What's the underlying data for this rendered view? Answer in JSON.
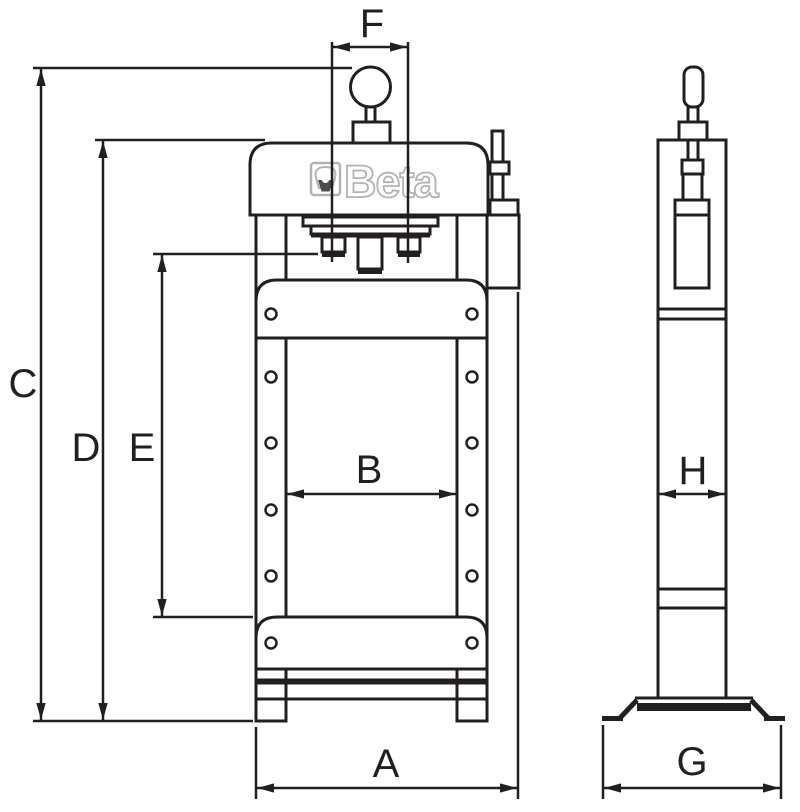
{
  "logo": {
    "text": "Beta"
  },
  "labels": {
    "A": "A",
    "B": "B",
    "C": "C",
    "D": "D",
    "E": "E",
    "F": "F",
    "G": "G",
    "H": "H"
  },
  "dimension_meanings": {
    "A": "front base overall width",
    "B": "inner width between columns",
    "C": "overall height to pump knob",
    "D": "height to top of head",
    "E": "ram-to-table working height",
    "F": "ram bolt spacing",
    "G": "side foot overall depth",
    "H": "column depth"
  },
  "colors": {
    "line_color": "#231f20",
    "background": "#ffffff",
    "logo_outline": "#b3b3b3",
    "logo_shade": "#4d4d4d"
  }
}
